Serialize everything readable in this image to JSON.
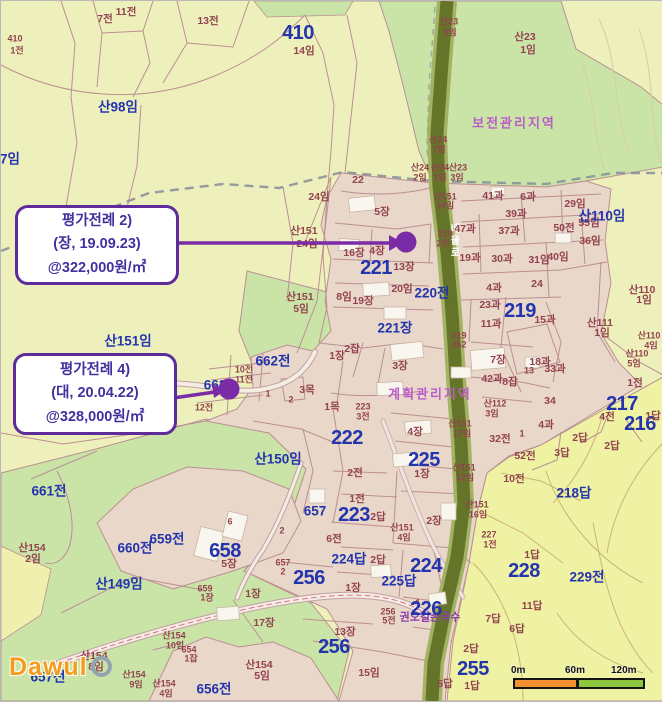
{
  "map": {
    "callouts": [
      {
        "line1": "평가전례 2)",
        "line2": "(장, 19.09.23)",
        "line3": "@322,000원/㎡"
      },
      {
        "line1": "평가전례 4)",
        "line2": "(대, 20.04.22)",
        "line3": "@328,000원/㎡"
      }
    ],
    "scale_bar": {
      "ticks": [
        "0m",
        "60m",
        "120m"
      ]
    },
    "watermark": "Dawul",
    "labels": [
      [
        "410",
        14,
        38,
        "sm"
      ],
      [
        "1전",
        16,
        50,
        "sm"
      ],
      [
        "7전",
        104,
        18,
        "mr"
      ],
      [
        "11전",
        125,
        11,
        "mr"
      ],
      [
        "13전",
        207,
        20,
        "mr"
      ],
      [
        "410",
        297,
        32,
        "xl"
      ],
      [
        "14임",
        303,
        50,
        "mr"
      ],
      [
        "산98임",
        117,
        106,
        "lg"
      ],
      [
        "7임",
        9,
        158,
        "lg"
      ],
      [
        "산23",
        448,
        21,
        "sm"
      ],
      [
        "5임",
        449,
        32,
        "sm"
      ],
      [
        "산23",
        524,
        36,
        "mr"
      ],
      [
        "1임",
        527,
        49,
        "mr"
      ],
      [
        "보전관리지역",
        513,
        122,
        "zone"
      ],
      [
        "산24",
        437,
        139,
        "sm"
      ],
      [
        "7임",
        438,
        149,
        "sm"
      ],
      [
        "산24",
        419,
        167,
        "sm"
      ],
      [
        "2임",
        419,
        177,
        "sm"
      ],
      [
        "산24",
        439,
        167,
        "sm"
      ],
      [
        "1임",
        439,
        177,
        "sm"
      ],
      [
        "산23",
        457,
        167,
        "sm"
      ],
      [
        "3임",
        456,
        177,
        "sm"
      ],
      [
        "산151",
        444,
        196,
        "sm"
      ],
      [
        "14임",
        444,
        205,
        "sm"
      ],
      [
        "22",
        357,
        179,
        "mr"
      ],
      [
        "24임",
        318,
        196,
        "mr"
      ],
      [
        "산151",
        303,
        230,
        "mr"
      ],
      [
        "24임",
        306,
        243,
        "mr"
      ],
      [
        "산151",
        299,
        296,
        "mr"
      ],
      [
        "5임",
        300,
        308,
        "mr"
      ],
      [
        "산151임",
        127,
        340,
        "lg"
      ],
      [
        "5장",
        381,
        211,
        "mr"
      ],
      [
        "16장",
        353,
        252,
        "mr"
      ],
      [
        "4장",
        376,
        250,
        "mr"
      ],
      [
        "13장",
        403,
        266,
        "mr"
      ],
      [
        "221",
        375,
        267,
        "xl"
      ],
      [
        "20임",
        401,
        288,
        "mr"
      ],
      [
        "8임",
        343,
        296,
        "mr"
      ],
      [
        "19장",
        362,
        300,
        "mr"
      ],
      [
        "220전",
        431,
        292,
        "lg"
      ],
      [
        "220",
        444,
        233,
        "sm"
      ],
      [
        "2전",
        442,
        243,
        "sm"
      ],
      [
        "221장",
        394,
        327,
        "lg"
      ],
      [
        "1장",
        336,
        355,
        "mr"
      ],
      [
        "2잡",
        351,
        348,
        "mr"
      ],
      [
        "3장",
        399,
        365,
        "mr"
      ],
      [
        "계획관리지역",
        429,
        393,
        "zone"
      ],
      [
        "배울로",
        452,
        240,
        "roadv"
      ],
      [
        "662전",
        272,
        360,
        "lg"
      ],
      [
        "10전",
        243,
        369,
        "sm"
      ],
      [
        "11전",
        243,
        379,
        "sm"
      ],
      [
        "662",
        214,
        384,
        "lg"
      ],
      [
        "12전",
        203,
        407,
        "sm"
      ],
      [
        "1",
        267,
        393,
        "sm"
      ],
      [
        "3목",
        306,
        389,
        "mr"
      ],
      [
        "2",
        290,
        399,
        "sm"
      ],
      [
        "1목",
        331,
        406,
        "mr"
      ],
      [
        "223",
        362,
        406,
        "sm"
      ],
      [
        "3전",
        362,
        416,
        "sm"
      ],
      [
        "222",
        346,
        437,
        "xl"
      ],
      [
        "산150임",
        277,
        458,
        "lg"
      ],
      [
        "2전",
        354,
        472,
        "mr"
      ],
      [
        "1전",
        356,
        498,
        "mr"
      ],
      [
        "657",
        314,
        510,
        "lg"
      ],
      [
        "223",
        353,
        514,
        "xl"
      ],
      [
        "2답",
        377,
        516,
        "mr"
      ],
      [
        "6전",
        333,
        538,
        "mr"
      ],
      [
        "2",
        281,
        530,
        "sm"
      ],
      [
        "4장",
        414,
        431,
        "mr"
      ],
      [
        "225",
        423,
        459,
        "xl"
      ],
      [
        "1장",
        421,
        473,
        "mr"
      ],
      [
        "2장",
        433,
        520,
        "mr"
      ],
      [
        "산151",
        401,
        527,
        "sm"
      ],
      [
        "4임",
        403,
        537,
        "sm"
      ],
      [
        "224답",
        348,
        558,
        "lg"
      ],
      [
        "2답",
        377,
        559,
        "mr"
      ],
      [
        "224",
        425,
        565,
        "xl"
      ],
      [
        "225답",
        398,
        580,
        "lg"
      ],
      [
        "1장",
        352,
        587,
        "mr"
      ],
      [
        "256",
        308,
        577,
        "xl"
      ],
      [
        "657",
        282,
        562,
        "sm"
      ],
      [
        "2",
        282,
        571,
        "sm"
      ],
      [
        "1장",
        252,
        593,
        "mr"
      ],
      [
        "17장",
        263,
        622,
        "mr"
      ],
      [
        "13장",
        344,
        631,
        "mr"
      ],
      [
        "256",
        333,
        646,
        "xl"
      ],
      [
        "15임",
        368,
        672,
        "mr"
      ],
      [
        "산154",
        258,
        664,
        "mr"
      ],
      [
        "5임",
        261,
        675,
        "mr"
      ],
      [
        "656전",
        213,
        688,
        "lg"
      ],
      [
        "654",
        188,
        649,
        "sm"
      ],
      [
        "1잡",
        190,
        658,
        "sm"
      ],
      [
        "산154",
        173,
        635,
        "sm"
      ],
      [
        "10임",
        174,
        645,
        "sm"
      ],
      [
        "산154",
        93,
        655,
        "mr"
      ],
      [
        "8임",
        95,
        666,
        "mr"
      ],
      [
        "산154",
        133,
        674,
        "sm"
      ],
      [
        "9임",
        135,
        684,
        "sm"
      ],
      [
        "산154",
        163,
        683,
        "sm"
      ],
      [
        "4임",
        165,
        693,
        "sm"
      ],
      [
        "657전",
        47,
        676,
        "lg"
      ],
      [
        "659",
        204,
        588,
        "sm"
      ],
      [
        "1장",
        206,
        597,
        "sm"
      ],
      [
        "658",
        224,
        550,
        "xl"
      ],
      [
        "5장",
        228,
        563,
        "mr"
      ],
      [
        "659전",
        166,
        538,
        "lg"
      ],
      [
        "660전",
        134,
        547,
        "lg"
      ],
      [
        "661전",
        48,
        490,
        "lg"
      ],
      [
        "산149임",
        118,
        583,
        "lg"
      ],
      [
        "산154",
        31,
        547,
        "mr"
      ],
      [
        "2임",
        32,
        558,
        "mr"
      ],
      [
        "6",
        229,
        521,
        "sm"
      ],
      [
        "권오길손국수",
        429,
        617,
        "poi"
      ],
      [
        "256",
        387,
        611,
        "sm"
      ],
      [
        "5전",
        388,
        620,
        "sm"
      ],
      [
        "4",
        416,
        602,
        "sm"
      ],
      [
        "226",
        425,
        608,
        "xl"
      ],
      [
        "11답",
        531,
        605,
        "mr"
      ],
      [
        "7답",
        492,
        618,
        "mr"
      ],
      [
        "6답",
        516,
        628,
        "mr"
      ],
      [
        "2답",
        470,
        648,
        "mr"
      ],
      [
        "255",
        472,
        668,
        "xl"
      ],
      [
        "5답",
        444,
        683,
        "mr"
      ],
      [
        "1답",
        471,
        685,
        "mr"
      ],
      [
        "228",
        523,
        570,
        "xl"
      ],
      [
        "1답",
        531,
        554,
        "mr"
      ],
      [
        "229전",
        586,
        576,
        "lg"
      ],
      [
        "218답",
        573,
        492,
        "lg"
      ],
      [
        "산151",
        476,
        504,
        "sm"
      ],
      [
        "16임",
        477,
        514,
        "sm"
      ],
      [
        "227",
        488,
        534,
        "sm"
      ],
      [
        "1전",
        489,
        544,
        "sm"
      ],
      [
        "산151",
        463,
        467,
        "sm"
      ],
      [
        "12임",
        464,
        477,
        "sm"
      ],
      [
        "산151",
        459,
        423,
        "sm"
      ],
      [
        "17임",
        461,
        433,
        "sm"
      ],
      [
        "산112",
        494,
        403,
        "sm"
      ],
      [
        "3임",
        491,
        413,
        "sm"
      ],
      [
        "32전",
        499,
        438,
        "mr"
      ],
      [
        "1",
        521,
        433,
        "sm"
      ],
      [
        "52전",
        524,
        455,
        "mr"
      ],
      [
        "10전",
        513,
        478,
        "mr"
      ],
      [
        "219",
        519,
        310,
        "xl"
      ],
      [
        "4과",
        493,
        287,
        "mr"
      ],
      [
        "24",
        536,
        283,
        "mr"
      ],
      [
        "23과",
        489,
        304,
        "mr"
      ],
      [
        "11과",
        490,
        323,
        "mr"
      ],
      [
        "15과",
        544,
        319,
        "mr"
      ],
      [
        "7장",
        497,
        359,
        "mr"
      ],
      [
        "18과",
        539,
        361,
        "mr"
      ],
      [
        "33과",
        554,
        368,
        "mr"
      ],
      [
        "13",
        528,
        370,
        "sm"
      ],
      [
        "42과",
        491,
        378,
        "mr"
      ],
      [
        "8잡",
        509,
        381,
        "mr"
      ],
      [
        "219",
        458,
        335,
        "sm"
      ],
      [
        "452",
        458,
        344,
        "sm"
      ],
      [
        "41과",
        492,
        195,
        "mr"
      ],
      [
        "6과",
        527,
        196,
        "mr"
      ],
      [
        "29임",
        574,
        203,
        "mr"
      ],
      [
        "39과",
        515,
        213,
        "mr"
      ],
      [
        "37과",
        508,
        230,
        "mr"
      ],
      [
        "47과",
        464,
        228,
        "mr"
      ],
      [
        "50전",
        563,
        227,
        "mr"
      ],
      [
        "55임",
        588,
        222,
        "mr"
      ],
      [
        "36임",
        589,
        240,
        "mr"
      ],
      [
        "19과",
        469,
        257,
        "mr"
      ],
      [
        "30과",
        501,
        258,
        "mr"
      ],
      [
        "31임",
        538,
        259,
        "mr"
      ],
      [
        "40임",
        557,
        256,
        "mr"
      ],
      [
        "산110임",
        601,
        215,
        "lg"
      ],
      [
        "산111",
        599,
        322,
        "mr"
      ],
      [
        "1임",
        601,
        332,
        "mr"
      ],
      [
        "산110",
        641,
        289,
        "mr"
      ],
      [
        "1임",
        643,
        299,
        "mr"
      ],
      [
        "산110",
        648,
        335,
        "sm"
      ],
      [
        "4임",
        650,
        345,
        "sm"
      ],
      [
        "산110",
        636,
        353,
        "sm"
      ],
      [
        "5임",
        633,
        363,
        "sm"
      ],
      [
        "1전",
        634,
        382,
        "mr"
      ],
      [
        "34",
        549,
        400,
        "mr"
      ],
      [
        "4과",
        545,
        424,
        "mr"
      ],
      [
        "217",
        621,
        403,
        "xl"
      ],
      [
        "216",
        639,
        423,
        "xl"
      ],
      [
        "1답",
        652,
        415,
        "mr"
      ],
      [
        "4전",
        606,
        416,
        "mr"
      ],
      [
        "2답",
        579,
        437,
        "mr"
      ],
      [
        "2답",
        611,
        445,
        "mr"
      ],
      [
        "3답",
        561,
        452,
        "mr"
      ]
    ]
  },
  "colors": {
    "accent_purple": "#5e2b9a",
    "marker_purple": "#7a2ba6",
    "road_olive": "#66762a",
    "forest_green": "#cae4a8",
    "paddy_yellow": "#eef2a2",
    "parcel_beige": "#e9d7c9",
    "label_blue": "#2334ad"
  }
}
